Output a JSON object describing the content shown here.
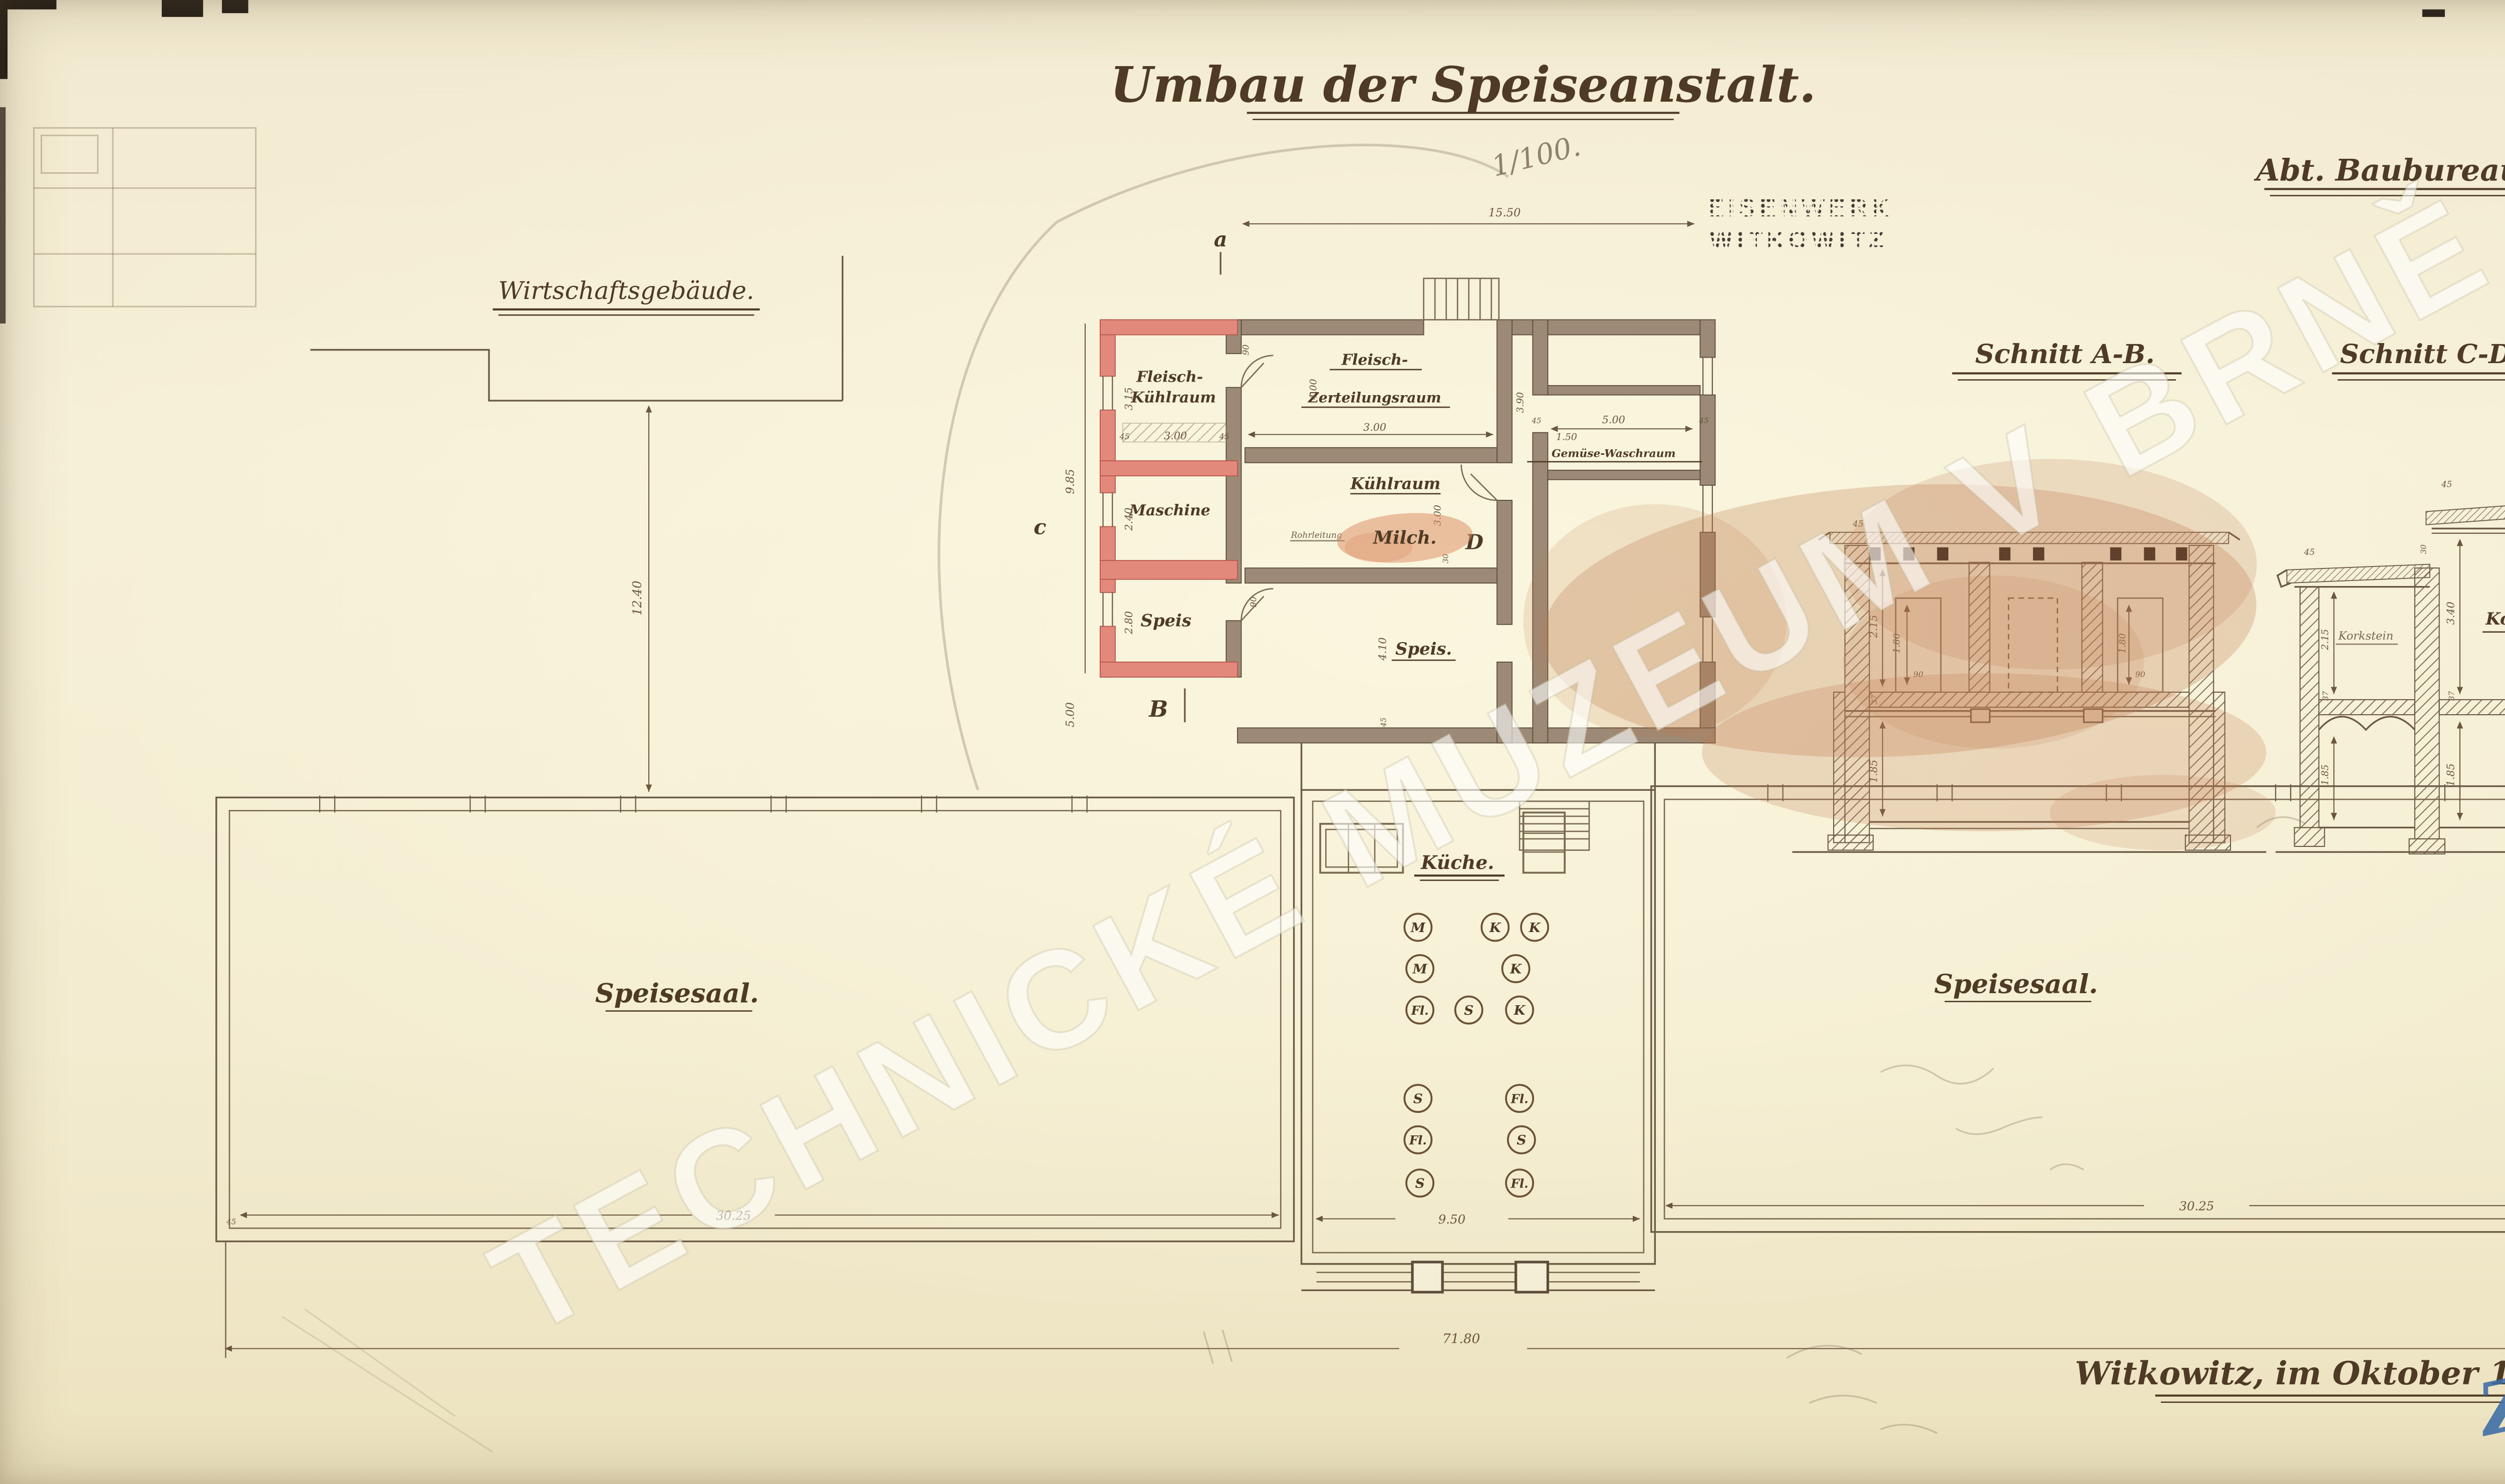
{
  "document": {
    "title": "Umbau der Speiseanstalt.",
    "scale_note": "1/100.",
    "department": "Abt. Baubureau.",
    "stamp_line1": "EISENWERK",
    "stamp_line2": "WITKOWITZ",
    "watermark": "TECHNICKÉ MUZEUM V BRNĚ",
    "signature": "Witkowitz, im Oktober 1910.",
    "registry_number": "ZNr 5743/8",
    "registry_suffix": "2"
  },
  "site": {
    "building_label": "Wirtschaftsgebäude.",
    "gap_dim": "12.40"
  },
  "plan": {
    "rooms": {
      "meat_cooling_1": "Fleisch-",
      "meat_cooling_2": "Kühlraum",
      "machine": "Maschine",
      "pantry_left": "Speis",
      "cutting_1": "Fleisch-",
      "cutting_2": "Zerteilungsraum",
      "cooling": "Kühlraum",
      "milk": "Milch.",
      "pipe_note": "Rohrleitung",
      "pantry_center": "Speis.",
      "veg_wash": "Gemüse-Waschraum",
      "kitchen": "Küche.",
      "hall_left": "Speisesaal.",
      "hall_right": "Speisesaal."
    },
    "markers": {
      "a": "a",
      "b": "B",
      "c": "c",
      "d": "D"
    },
    "dims": {
      "annex_width": "15.50",
      "flk_h": "3.15",
      "flk_w": "3.00",
      "mach_h": "2.40",
      "pantry_l_h": "2.80",
      "left_total": "9.85",
      "left_lower": "5.00",
      "cutting_w": "3.00",
      "cutting_h": "4.00",
      "cooling_h": "3.00",
      "jamb": "30",
      "pantry_c_h": "4.10",
      "corridor": "1.50",
      "veg_w": "5.00",
      "veg_h": "3.90",
      "door": "90",
      "wall": "45",
      "hall_left": "30.25",
      "hall_right": "30.25",
      "kitchen_w": "9.50",
      "total": "71.80"
    },
    "kettles": [
      "M",
      "K",
      "K",
      "M",
      "K",
      "Fl.",
      "S",
      "K",
      "S",
      "Fl.",
      "Fl.",
      "S",
      "S",
      "Fl."
    ]
  },
  "sections": {
    "ab": {
      "title": "Schnitt A-B.",
      "dims": {
        "roof": "45",
        "room": "2.15",
        "floor": "37",
        "cellar": "1.85",
        "door_h": "1.80",
        "door_w": "90"
      }
    },
    "cd": {
      "title": "Schnitt C-D.",
      "insulation": "Korkstein.",
      "insulation_small": "Korkstein",
      "dims": {
        "roof": "45",
        "roof_left": "45",
        "parapet": "30",
        "room_left": "2.15",
        "room_right": "3.40",
        "floor_left": "37",
        "floor_right": "37",
        "cellar_left": "1.85",
        "cellar_right": "1.85"
      }
    }
  }
}
